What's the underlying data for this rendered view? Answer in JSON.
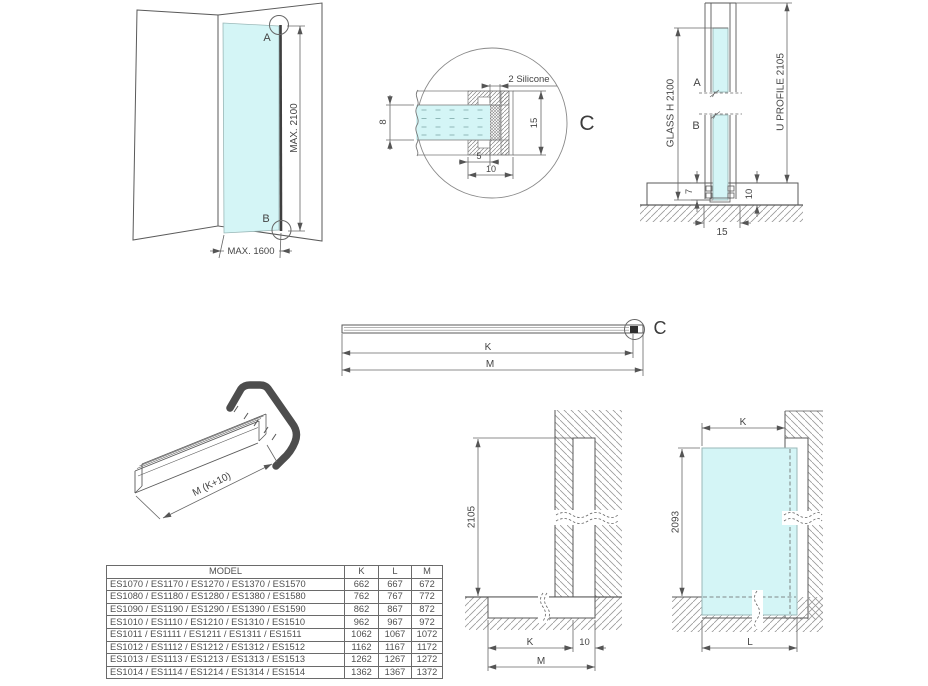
{
  "colors": {
    "glass_fill": "#d4f5f6",
    "line": "#555555",
    "accent_dark": "#4d4d4d"
  },
  "overview": {
    "point_a": "A",
    "point_b": "B",
    "max_height": "MAX. 2100",
    "max_width": "MAX. 1600"
  },
  "detail_c": {
    "silicone": "2 Silicone",
    "glass_thickness": "8",
    "profile_height": "15",
    "inset": "5",
    "depth": "10",
    "callout": "C"
  },
  "section": {
    "point_a": "A",
    "point_b": "B",
    "glass_height": "GLASS H 2100",
    "u_profile": "U PROFILE 2105",
    "dim_7": "7",
    "dim_10": "10",
    "dim_15": "15"
  },
  "profile_bar": {
    "dim_k": "K",
    "dim_m": "M",
    "callout": "C"
  },
  "isometric": {
    "length_label": "M (K+10)"
  },
  "wall_elevation": {
    "height": "2105",
    "dim_k": "K",
    "dim_10": "10",
    "dim_m": "M"
  },
  "glass_elevation": {
    "dim_k": "K",
    "height": "2093",
    "dim_l": "L"
  },
  "spec_table": {
    "headers": [
      "MODEL",
      "K",
      "L",
      "M"
    ],
    "rows": [
      {
        "model": "ES1070 / ES1170 / ES1270 / ES1370 / ES1570",
        "k": "662",
        "l": "667",
        "m": "672"
      },
      {
        "model": "ES1080 / ES1180 / ES1280 / ES1380 / ES1580",
        "k": "762",
        "l": "767",
        "m": "772"
      },
      {
        "model": "ES1090 / ES1190 / ES1290 / ES1390 / ES1590",
        "k": "862",
        "l": "867",
        "m": "872"
      },
      {
        "model": "ES1010 / ES1110 / ES1210 / ES1310 / ES1510",
        "k": "962",
        "l": "967",
        "m": "972"
      },
      {
        "model": "ES1011 / ES1111 / ES1211 / ES1311 / ES1511",
        "k": "1062",
        "l": "1067",
        "m": "1072"
      },
      {
        "model": "ES1012 / ES1112 / ES1212 / ES1312 / ES1512",
        "k": "1162",
        "l": "1167",
        "m": "1172"
      },
      {
        "model": "ES1013 / ES1113 / ES1213 / ES1313 / ES1513",
        "k": "1262",
        "l": "1267",
        "m": "1272"
      },
      {
        "model": "ES1014 / ES1114 / ES1214 / ES1314 / ES1514",
        "k": "1362",
        "l": "1367",
        "m": "1372"
      }
    ]
  }
}
